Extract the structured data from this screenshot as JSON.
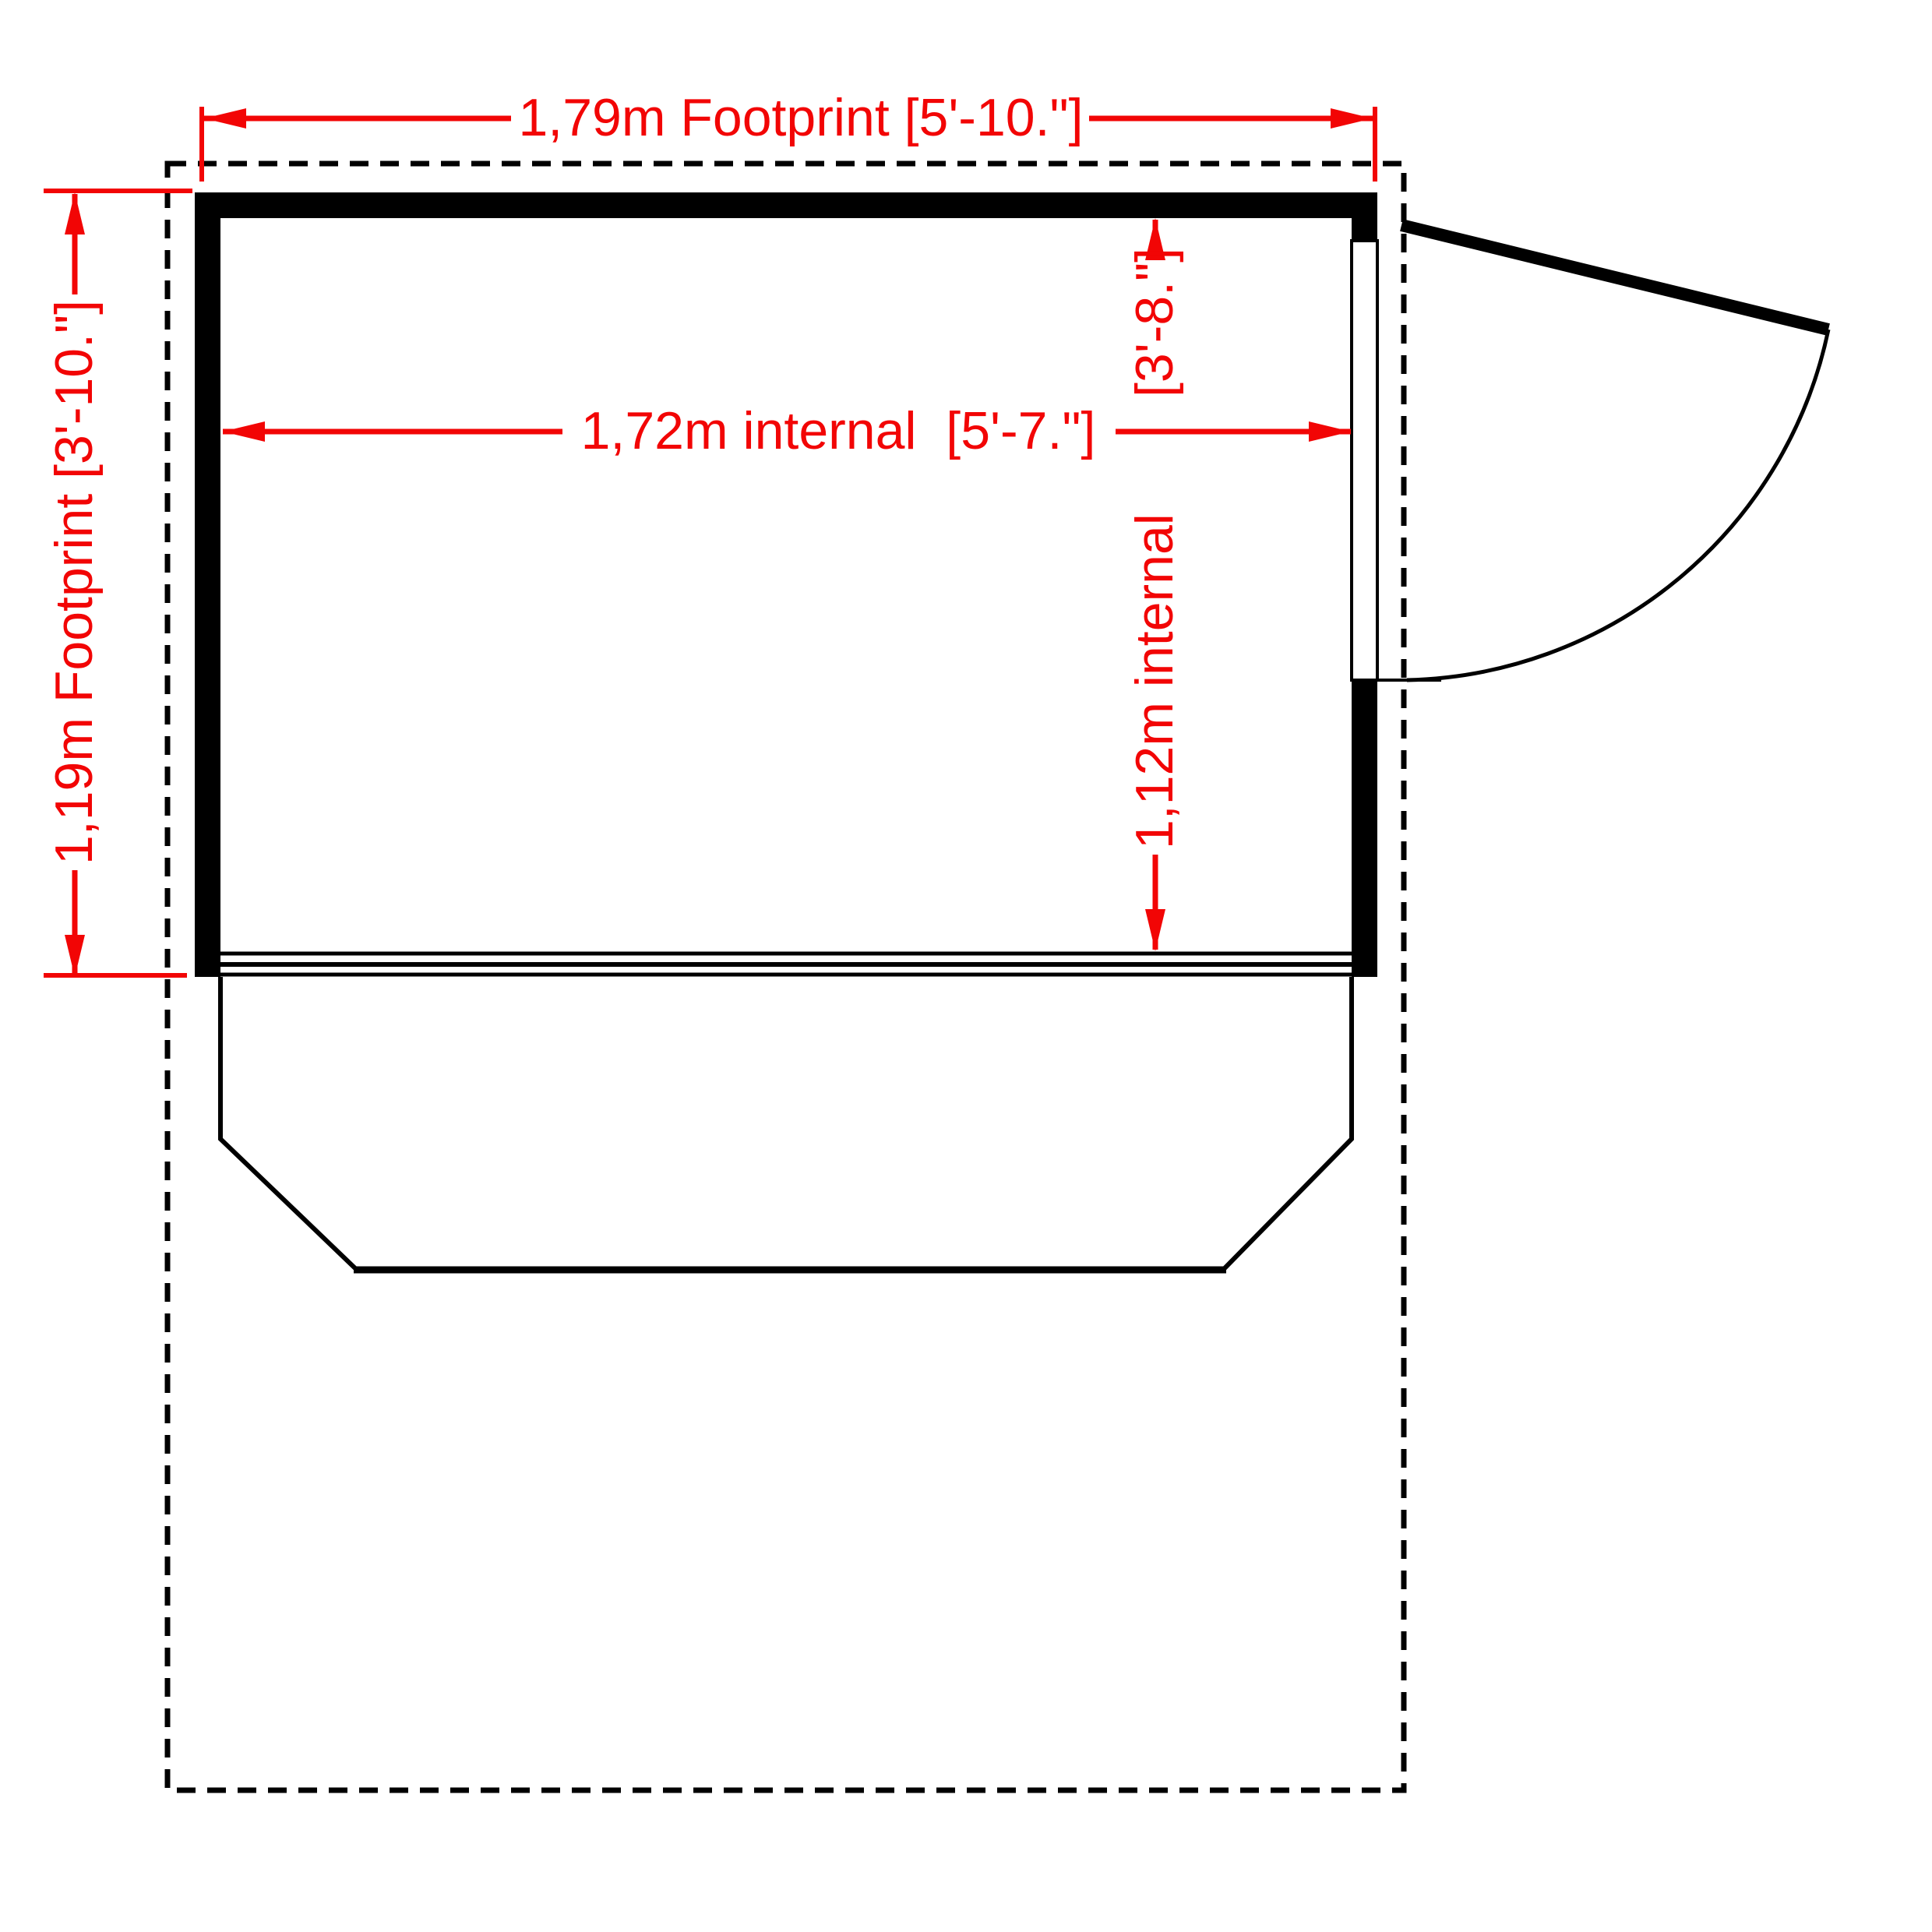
{
  "colors": {
    "dimension_red": "#f20505",
    "line_black": "#000000",
    "background": "#ffffff"
  },
  "dimensions": {
    "footprint_width": {
      "label": "1,79m Footprint [5'-10.\"]"
    },
    "footprint_depth": {
      "label": "1,19m Footprint [3'-10.\"]"
    },
    "internal_width": {
      "label": "1,72m internal  [5'-7.\"]"
    },
    "internal_depth": {
      "value": "1,12m internal",
      "unit": "[3'-8.\"]"
    }
  }
}
